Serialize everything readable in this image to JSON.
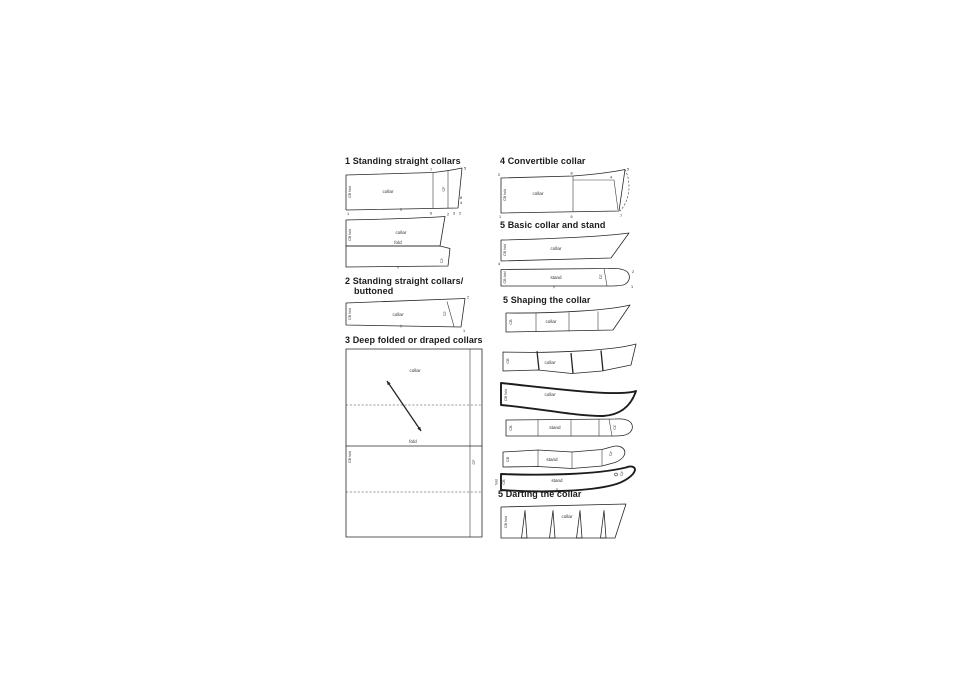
{
  "page": {
    "background": "#ffffff",
    "ink": "#262626"
  },
  "sections": {
    "standing": {
      "title": "1 Standing straight collars"
    },
    "buttoned": {
      "title_line1": "2 Standing straight collars/",
      "title_line2": "buttoned"
    },
    "deep": {
      "title": "3 Deep folded or draped collars"
    },
    "convertible": {
      "title": "4 Convertible collar"
    },
    "basic": {
      "title": "5 Basic collar and stand"
    },
    "shaping": {
      "title": "5 Shaping the collar"
    },
    "darting": {
      "title": "5 Darting the collar"
    }
  },
  "labels": {
    "collar": "collar",
    "fold": "fold",
    "stand": "stand",
    "cb_fold": "CB fold",
    "cb": "CB",
    "cf": "CF"
  },
  "digits": {
    "d1": "1",
    "d2": "2",
    "d3": "3",
    "d4": "4",
    "d5": "5",
    "d6": "6",
    "d7": "7",
    "d8": "8"
  }
}
